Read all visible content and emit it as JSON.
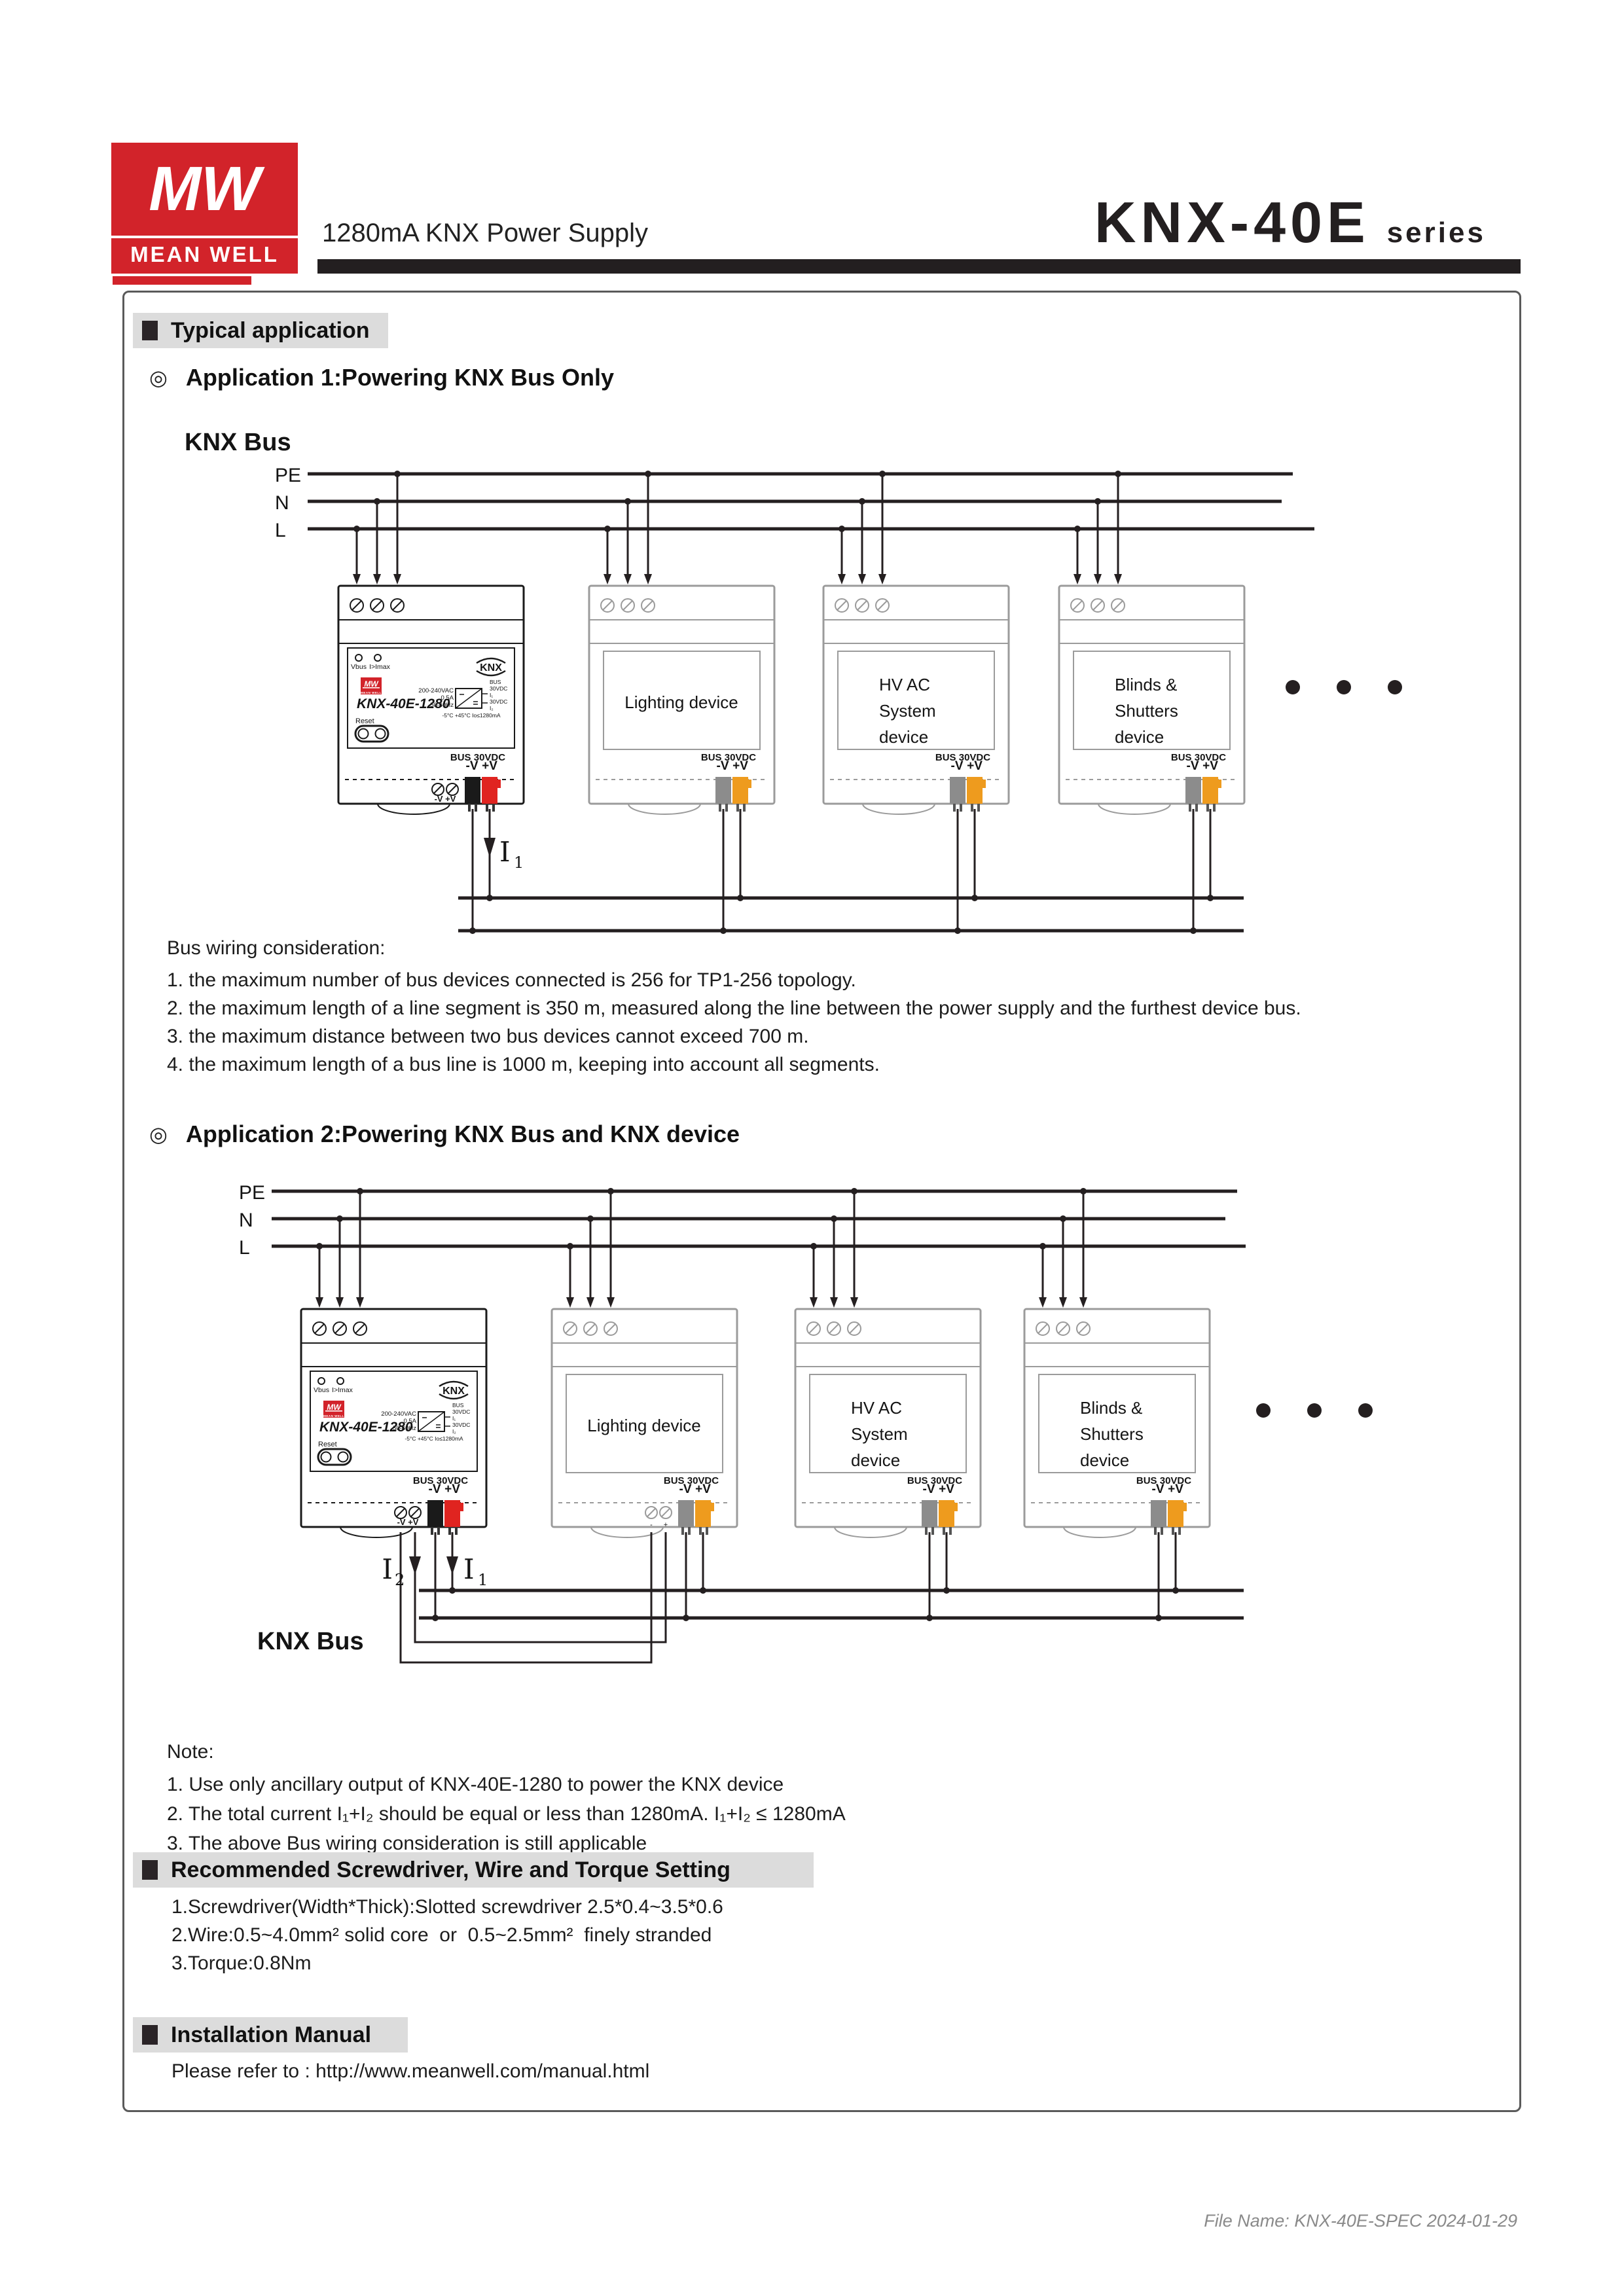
{
  "header": {
    "logo_mw": "MW",
    "logo_meanwell": "MEAN WELL",
    "subtitle": "1280mA KNX Power Supply",
    "series_name": "KNX-40E",
    "series_suffix": "series"
  },
  "sections": {
    "typical_application": "Typical application",
    "app1_title": "Application 1:Powering KNX Bus Only",
    "app2_title": "Application 2:Powering KNX Bus and KNX device",
    "screwdriver_title": "Recommended Screwdriver, Wire and Torque Setting",
    "installation_title": "Installation Manual"
  },
  "diagram": {
    "knx_bus_label": "KNX Bus",
    "rail_pe": "PE",
    "rail_n": "N",
    "rail_l": "L",
    "i_label": "I",
    "i1_sub": "1",
    "i2_sub": "2",
    "device_bus_label": "BUS 30VDC",
    "pin_minus": "-V",
    "pin_plus": "+V",
    "aux_minus": "-",
    "aux_plus": "+",
    "psu": {
      "model": "KNX-40E-1280",
      "led1": "Vbus",
      "led2": "I>Imax",
      "knx_logo": "KNX",
      "reset": "Reset",
      "in1": "200-240VAC",
      "in2": "0.5A",
      "in3": "50-60Hz",
      "out_bus": "BUS",
      "out_v": "30VDC",
      "out_i1": "I₁",
      "out_i2": "I₂",
      "temp": "-5°C +45°C Io≤1280mA",
      "aux_pins": "-V +V",
      "mw": "MW",
      "mw_sub": "MEAN WELL"
    },
    "devices": {
      "lighting": "Lighting device",
      "hvac1": "HV AC",
      "hvac2": "System",
      "hvac3": "device",
      "blinds1": "Blinds &",
      "blinds2": "Shutters",
      "blinds3": "device"
    }
  },
  "bus_wiring": {
    "title": "Bus wiring consideration:",
    "items": [
      "1. the maximum number of bus devices connected is 256 for TP1-256 topology.",
      "2. the maximum length of a line segment is 350 m, measured along the line between the power supply and the furthest device bus.",
      "3. the maximum distance between two bus devices cannot exceed 700 m.",
      "4. the maximum length of a bus line is 1000 m, keeping into account all segments."
    ]
  },
  "note": {
    "title": "Note:",
    "items": [
      "1. Use only ancillary output of KNX-40E-1280 to power the KNX device",
      "2. The total current I₁+I₂ should be equal or less than 1280mA. I₁+I₂ ≤ 1280mA",
      "3. The above Bus wiring consideration is still applicable"
    ]
  },
  "screwdriver": {
    "items": [
      "1.Screwdriver(Width*Thick):Slotted screwdriver 2.5*0.4~3.5*0.6",
      "2.Wire:0.5~4.0mm² solid core  or  0.5~2.5mm²  finely stranded",
      "3.Torque:0.8Nm"
    ]
  },
  "installation": {
    "text": "Please refer to : http://www.meanwell.com/manual.html"
  },
  "footer": {
    "file_info": "File Name: KNX-40E-SPEC  2024-01-29"
  },
  "colors": {
    "brand_red": "#d2232a",
    "connector_red": "#e02420",
    "connector_orange": "#ee9b1e",
    "connector_gray": "#8c8c8c"
  }
}
